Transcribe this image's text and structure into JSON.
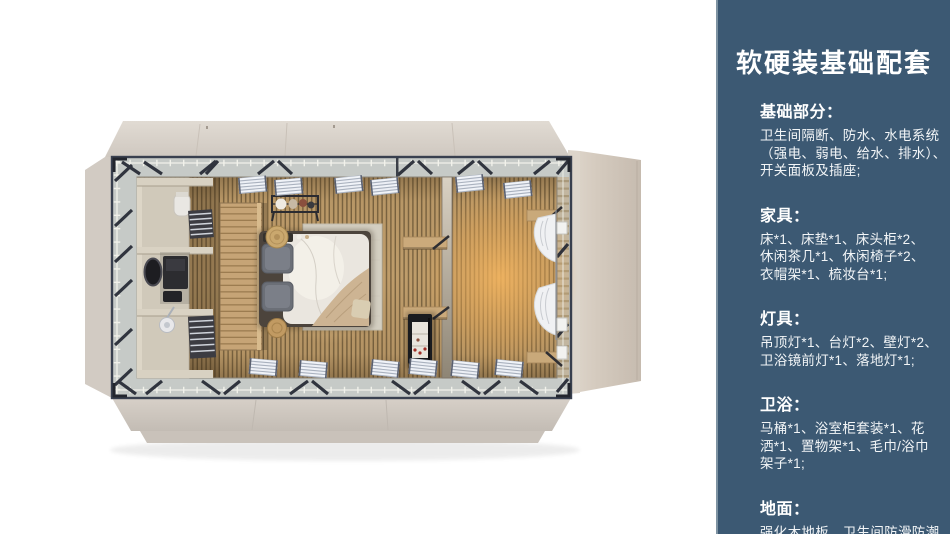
{
  "sidebar": {
    "title": "软硬装基础配套",
    "sections": [
      {
        "heading": "基础部分：",
        "lines": [
          "卫生间隔断、防水、水电系统",
          "（强电、弱电、给水、排水）、",
          "开关面板及插座;"
        ]
      },
      {
        "heading": "家具：",
        "lines": [
          "床*1、床垫*1、床头柜*2、",
          "休闲茶几*1、休闲椅子*2、",
          "衣帽架*1、梳妆台*1;"
        ]
      },
      {
        "heading": "灯具：",
        "lines": [
          "吊顶灯*1、台灯*2、壁灯*2、",
          "卫浴镜前灯*1、落地灯*1;"
        ]
      },
      {
        "heading": "卫浴：",
        "lines": [
          "马桶*1、浴室柜套装*1、花",
          "洒*1、置物架*1、毛巾/浴巾",
          "架子*1;"
        ]
      },
      {
        "heading": "地面：",
        "lines": [
          "强化木地板、卫生间防滑防潮",
          "石塑板;"
        ]
      }
    ]
  },
  "floorplan": {
    "type": "top-down-3d-render",
    "rooms": [
      "bathroom",
      "bedroom",
      "lounge"
    ],
    "elements": [
      "toilet",
      "vanity-with-mirror",
      "shower",
      "towel-radiators",
      "wardrobe-partition",
      "clothes-rack",
      "double-bed",
      "pillows",
      "rug",
      "straw-hat",
      "basket",
      "wall-shelves",
      "mini-bar",
      "glass-divider",
      "curtains",
      "wall-lamps",
      "louver-panels",
      "steel-frame-with-braces"
    ],
    "palette": {
      "panel_bg": "#3c5973",
      "panel_edge": "#7e93a2",
      "panel_text": "#ffffff",
      "wall_beige": "#d5cec6",
      "frame_dark": "#242833",
      "band_gray": "#c6cac7",
      "floor_wood": "#bf9d6b",
      "floor_glow": "#e8a854",
      "bathroom_beige": "#d0c9ba",
      "bed_white": "#eae6df",
      "pillow_gray": "#6b6f77",
      "throw_tan": "#cdb493"
    }
  }
}
